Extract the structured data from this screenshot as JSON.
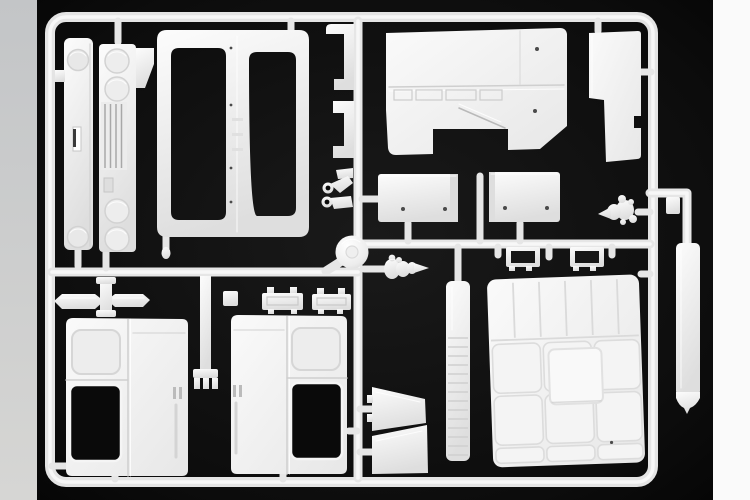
{
  "image": {
    "type": "product-photo",
    "subject": "white injection-molded model-kit sprue (truck cab parts) photographed on a black background",
    "photo_background_color": "#0b0b0b",
    "left_border_color": "#cbcdce",
    "right_border_color": "#fafafa",
    "plastic_highlight_color": "#fcfcfc",
    "plastic_shade_color": "#dedede",
    "runner_color": "#e6e6e6",
    "parts": [
      "sprue-outer-frame",
      "headlamp-panel",
      "grille-panel",
      "windscreen-frame",
      "window-bracket-upper",
      "window-bracket-lower",
      "cab-rear-panel",
      "side-panel",
      "bunk-panel-left",
      "bunk-panel-right",
      "step-part-left",
      "step-part-right",
      "dome-disc",
      "air-horn-center",
      "air-horn-right",
      "hook-ring-parts",
      "spindle-part",
      "prong-part",
      "tray-parts",
      "cab-door-left",
      "cab-door-right",
      "wedge-parts",
      "ribbed-pillar",
      "roof-liner-panel",
      "exhaust-strip",
      "small-tab-part"
    ]
  }
}
